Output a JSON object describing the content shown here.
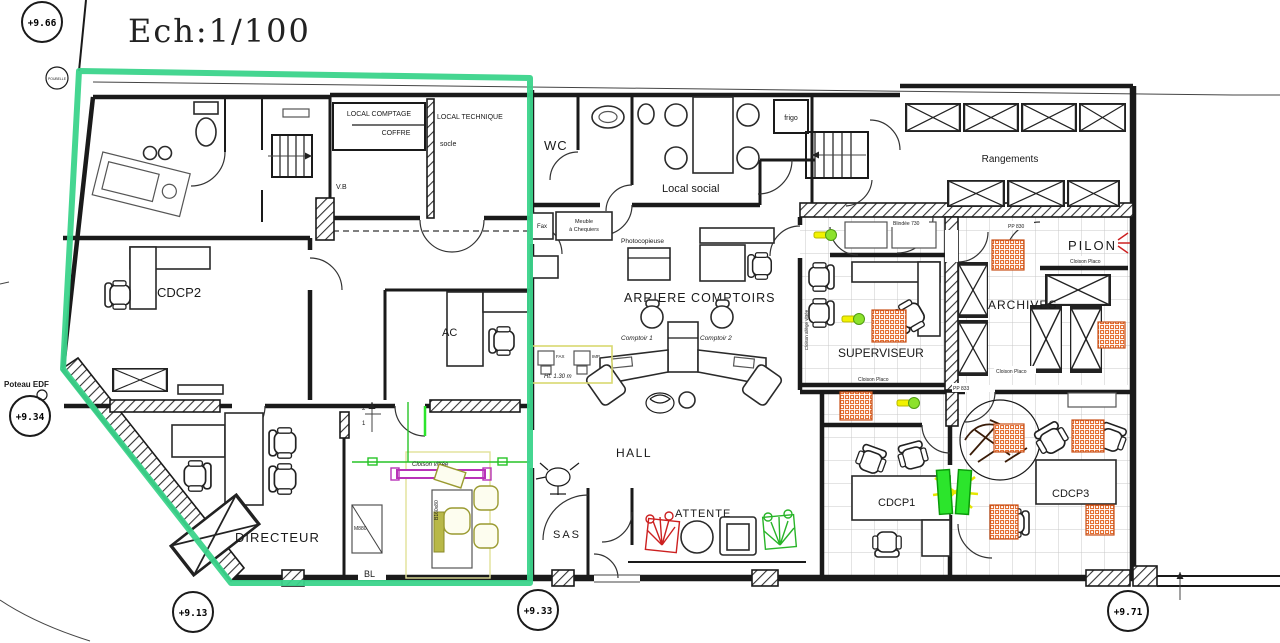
{
  "title": "Ech:1/100",
  "levels": {
    "top_left": "+9.66",
    "poubelle": "POUBELLE",
    "left": "+9.34",
    "bottom_left": "+9.13",
    "bottom_center": "+9.33",
    "bottom_right": "+9.71"
  },
  "rooms": {
    "local_comptage_l1": "LOCAL COMPTAGE",
    "local_comptage_l2": "COFFRE",
    "local_technique": "LOCAL TECHNIQUE",
    "local_technique_sub": "socle",
    "wc": "WC",
    "local_social": "Local social",
    "rangements": "Rangements",
    "pilon": "PILON",
    "archives": "ARCHIVES",
    "superviseur": "SUPERVISEUR",
    "arriere_comptoirs": "ARRIERE COMPTOIRS",
    "comptoir1": "Comptoir 1",
    "comptoir2": "Comptoir 2",
    "hall": "HALL",
    "attente": "ATTENTE",
    "sas": "SAS",
    "directeur": "DIRECTEUR",
    "cdcp1": "CDCP1",
    "cdcp2": "CDCP2",
    "cdcp3": "CDCP3",
    "ac": "AC"
  },
  "annotations": {
    "poteau_edf": "Poteau EDF",
    "bl": "BL",
    "vb": "V.B",
    "frigo": "frigo",
    "fax": "Fax",
    "meuble_l1": "Meuble",
    "meuble_l2": "à Chequiers",
    "photocopieuse": "Photocopieuse",
    "cloison_vitree": "Cloison vitrée",
    "cloison_placo": "Cloison Placo",
    "cloison_allege": "Cloison allège vitrée",
    "blindee": "Blindée 730",
    "pp830": "PP 830",
    "pp833": "PP 833",
    "m880": "M880",
    "b160": "B160x80",
    "ht130": "Ht: 1.30 m",
    "fax_small": "FAX",
    "imp_small": "IMP",
    "mark2": "2",
    "mark1": "1"
  },
  "colors": {
    "highlight_zone": "#3bd48b",
    "door_highlight": "#2ce52c",
    "equipment_highlight": "#e6e600",
    "partition_glass": "#b832b8",
    "column_hatch": "#e2601e",
    "plant_red": "#cc2020",
    "plant_green": "#28b428",
    "walls": "#1a1a1a"
  }
}
